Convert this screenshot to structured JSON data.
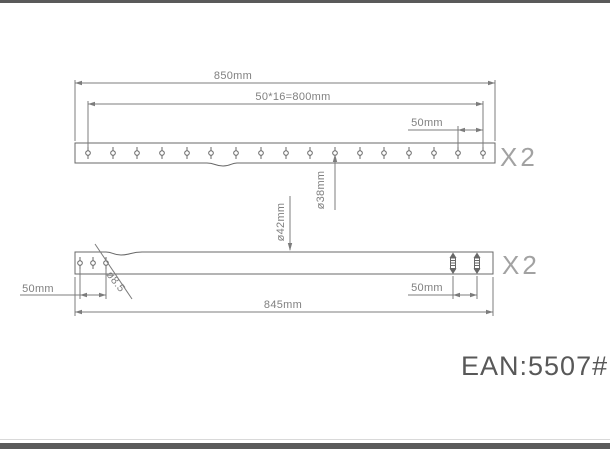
{
  "top_part": {
    "overall_length": "850mm",
    "hole_pitch": "50*16=800mm",
    "end_offset": "50mm",
    "tube_inner_dia": "ø38mm",
    "quantity": "X2"
  },
  "bottom_part": {
    "overall_length": "845mm",
    "left_hole_pitch": "50mm",
    "right_stud_pitch": "50mm",
    "tube_outer_dia": "ø42mm",
    "hole_dia": "ø8.5",
    "quantity": "X2"
  },
  "footer": {
    "ean": "EAN:5507#"
  },
  "colors": {
    "outline": "#686868",
    "dimension_line": "#7c7c7c",
    "dimension_text": "#808080",
    "quantity_text": "#a2a2a2",
    "ean_text": "#585858",
    "border": "#5a5a5a",
    "background": "#ffffff"
  }
}
